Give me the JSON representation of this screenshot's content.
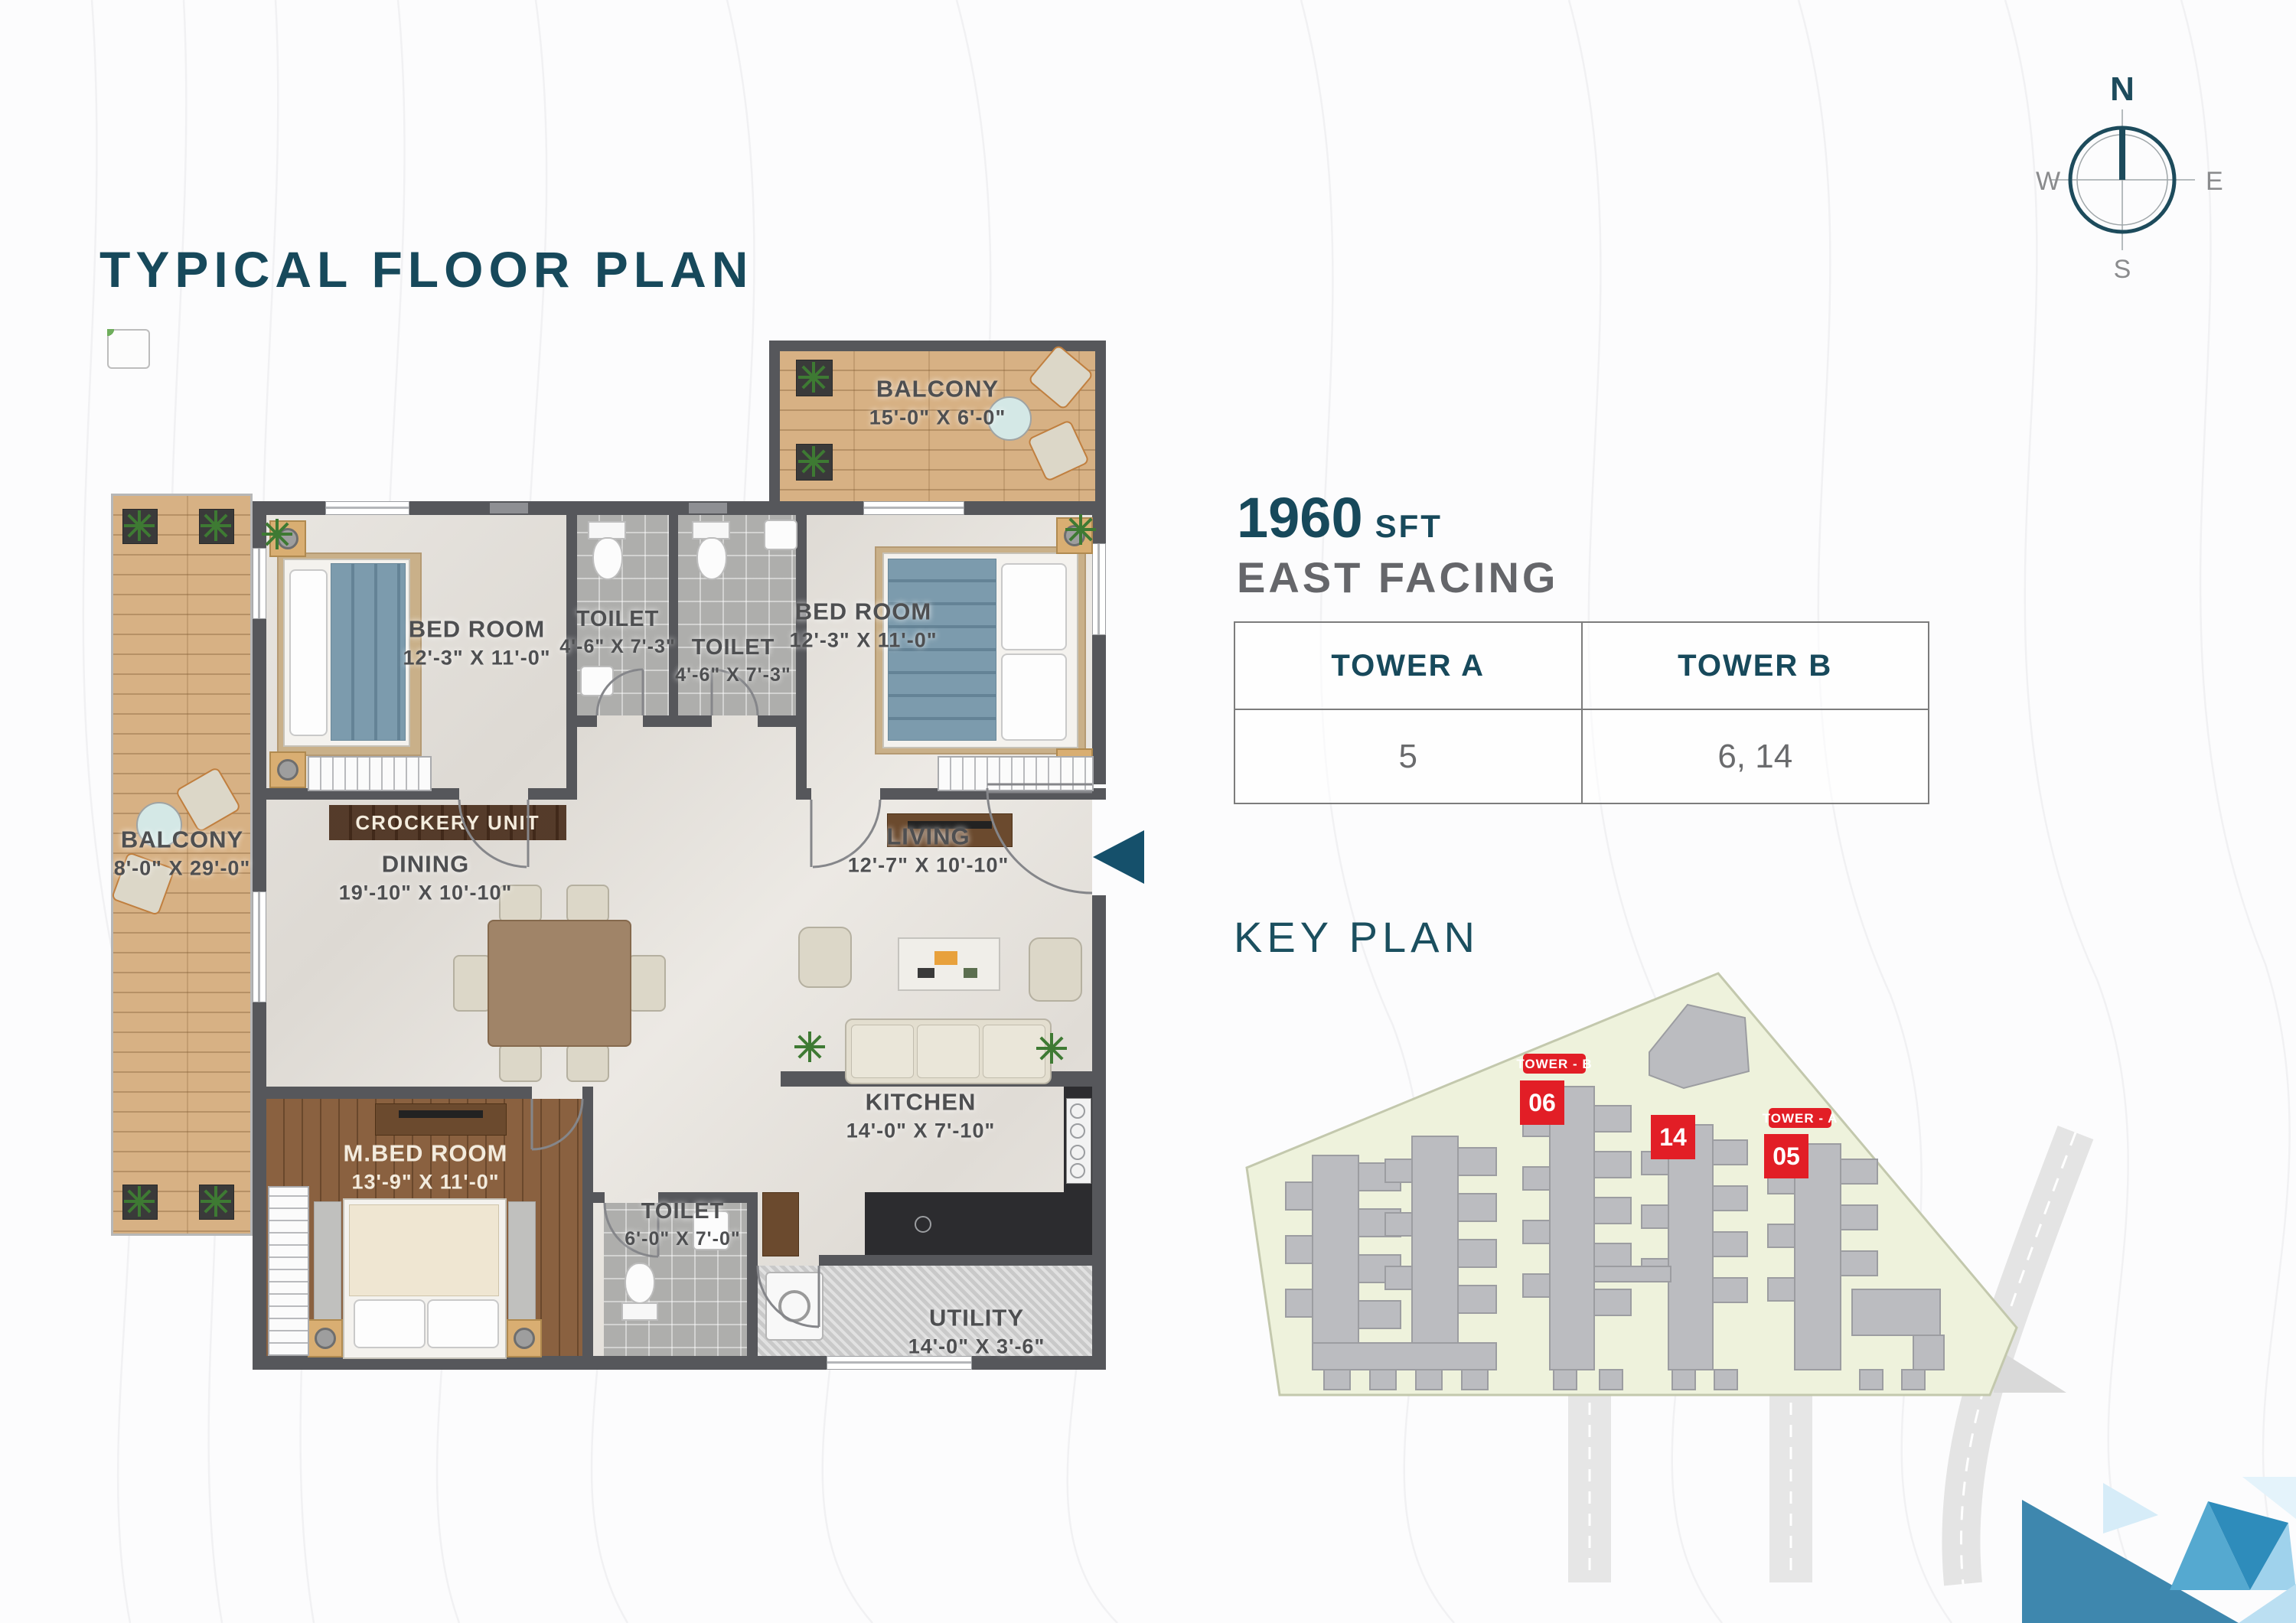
{
  "page": {
    "title": "TYPICAL FLOOR PLAN"
  },
  "compass": {
    "n": "N",
    "e": "E",
    "s": "S",
    "w": "W"
  },
  "unit": {
    "area": "1960",
    "area_unit": "SFT",
    "facing": "EAST FACING"
  },
  "tower_table": {
    "headers": [
      "TOWER A",
      "TOWER B"
    ],
    "rows": [
      [
        "5",
        "6, 14"
      ]
    ]
  },
  "key_plan": {
    "title": "KEY PLAN",
    "tower_b_tag": "TOWER - B",
    "tower_a_tag": "TOWER - A",
    "block_06": "06",
    "block_14": "14",
    "block_05": "05"
  },
  "floor_plan": {
    "balcony_top": {
      "name": "BALCONY",
      "dims": "15'-0\" X 6'-0\""
    },
    "bed_room_1": {
      "name": "BED ROOM",
      "dims": "12'-3\" X 11'-0\""
    },
    "toilet_1": {
      "name": "TOILET",
      "dims": "4'-6\" X 7'-3\""
    },
    "toilet_2": {
      "name": "TOILET",
      "dims": "4'-6\" X 7'-3\""
    },
    "bed_room_2": {
      "name": "BED ROOM",
      "dims": "12'-3\" X 11'-0\""
    },
    "balcony_left": {
      "name": "BALCONY",
      "dims": "8'-0\" X 29'-0\""
    },
    "crockery": {
      "name": "CROCKERY UNIT"
    },
    "dining": {
      "name": "DINING",
      "dims": "19'-10\" X 10'-10\""
    },
    "living": {
      "name": "LIVING",
      "dims": "12'-7\" X 10'-10\""
    },
    "m_bed_room": {
      "name": "M.BED ROOM",
      "dims": "13'-9\" X 11'-0\""
    },
    "toilet_3": {
      "name": "TOILET",
      "dims": "6'-0\" X 7'-0\""
    },
    "kitchen": {
      "name": "KITCHEN",
      "dims": "14'-0\" X 7'-10\""
    },
    "utility": {
      "name": "UTILITY",
      "dims": "14'-0\" X 3'-6\""
    }
  },
  "colors": {
    "accent_teal": "#17495B",
    "key_plan_red": "#E21E26",
    "site_green": "#EEF2DC",
    "wall_gray": "#56575B",
    "logo_blues": [
      "#E4F3FB",
      "#BBDFF2",
      "#9FD2EC",
      "#55A9D0",
      "#3E87AE",
      "#2E8CBB"
    ]
  }
}
